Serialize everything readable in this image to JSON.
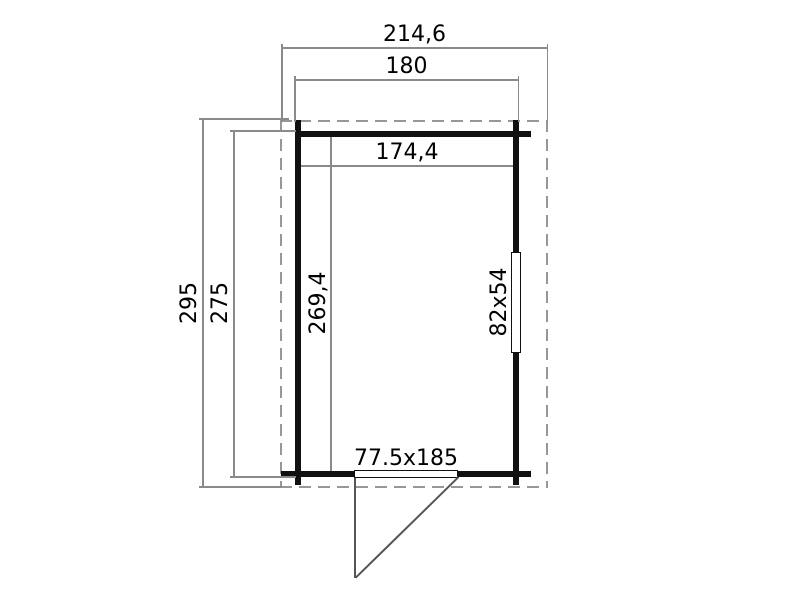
{
  "drawing": {
    "type": "floor-plan",
    "dimensions": {
      "outer_width": "214,6",
      "wall_width": "180",
      "inner_width": "174,4",
      "outer_depth": "295",
      "wall_depth": "275",
      "inner_depth": "269,4",
      "window_size": "82x54",
      "door_size": "77.5x185"
    }
  },
  "colors": {
    "wall": "#111111",
    "dim_line": "#8a8a8a",
    "dashed": "#979797",
    "swing": "#555555",
    "text": "#000000",
    "background": "#ffffff"
  }
}
